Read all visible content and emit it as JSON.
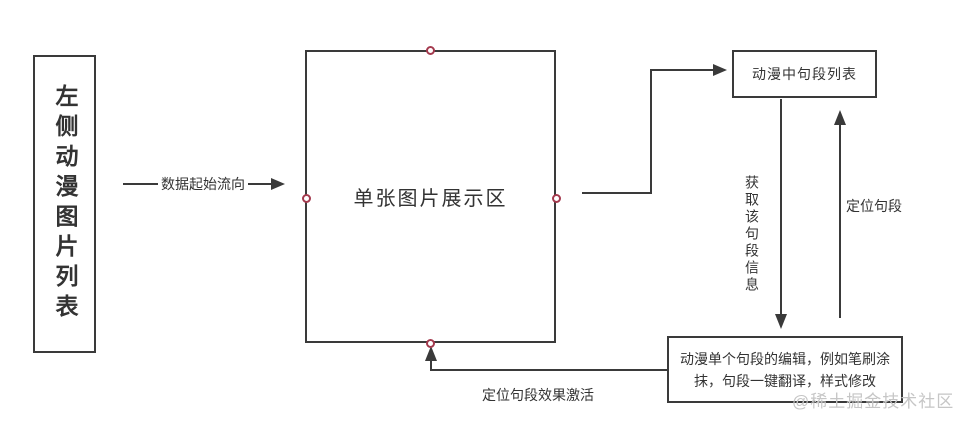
{
  "diagram": {
    "left_box": {
      "label": "左侧动漫图片列表"
    },
    "center_box": {
      "label": "单张图片展示区"
    },
    "top_right_box": {
      "label": "动漫中句段列表"
    },
    "bottom_right_box": {
      "label": "动漫单个句段的编辑，例如笔刷涂抹，句段一键翻译，样式修改"
    },
    "arrows": {
      "data_flow_label": "数据起始流向",
      "get_segment_info_label": "获取该句段信息",
      "locate_segment_label": "定位句段",
      "locate_effect_label": "定位句段效果激活"
    },
    "watermark": "@稀土掘金技术社区",
    "colors": {
      "line": "#3a3a3a",
      "anchor": "#a43a4e",
      "text": "#333333",
      "watermark": "#c6c6c6"
    }
  }
}
